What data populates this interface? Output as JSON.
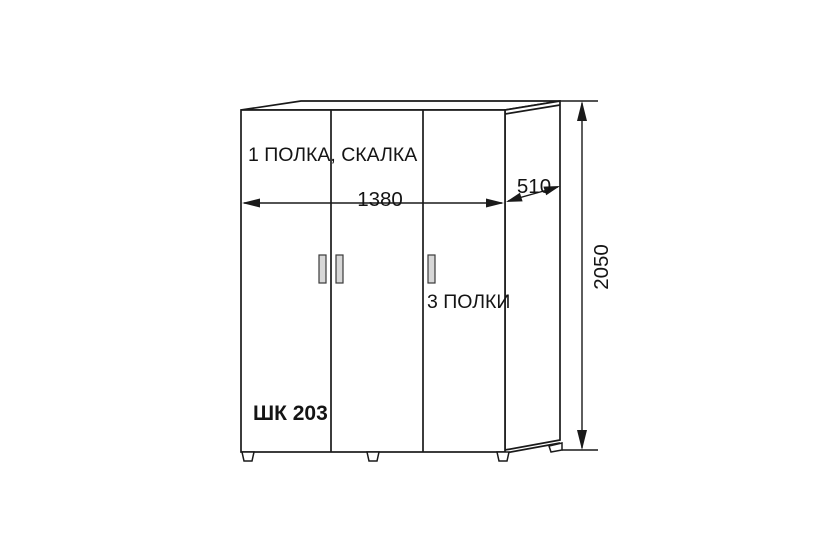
{
  "drawing": {
    "type": "furniture-dimension-drawing",
    "product_code": "ШК 203",
    "labels": {
      "left_section": "1 ПОЛКА, СКАЛКА",
      "right_section": "3 ПОЛКИ"
    },
    "dimensions": {
      "width": "1380",
      "depth": "510",
      "height": "2050"
    },
    "colors": {
      "line": "#1a1a1a",
      "text": "#141414",
      "handle_fill": "#d7d7d7",
      "background": "#ffffff"
    }
  }
}
